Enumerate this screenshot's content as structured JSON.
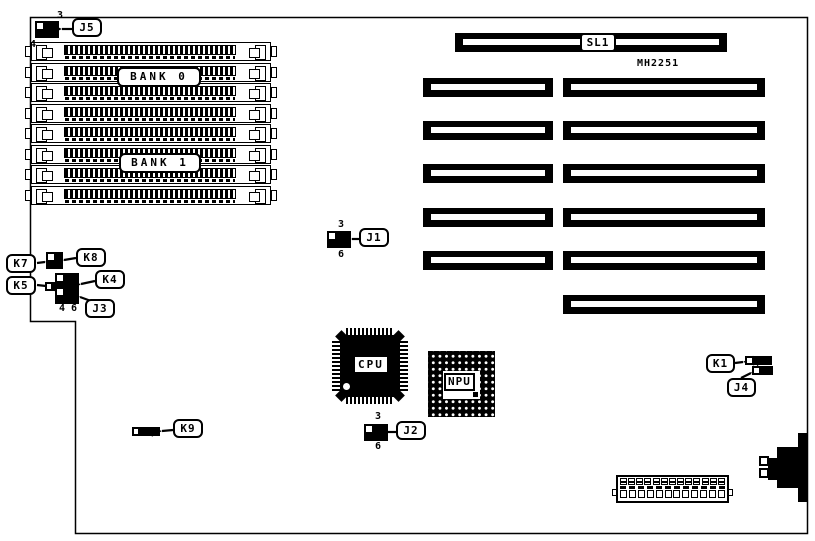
{
  "diagram": {
    "type": "motherboard connector location diagram",
    "part_number": "MH2251",
    "colors": {
      "ink": "#000000",
      "paper": "#ffffff"
    }
  },
  "labels": {
    "j1": "J1",
    "j2": "J2",
    "j3": "J3",
    "j4": "J4",
    "j5": "J5",
    "k1": "K1",
    "k4": "K4",
    "k5": "K5",
    "k7": "K7",
    "k8": "K8",
    "k9": "K9",
    "sl1": "SL1",
    "bank0": "BANK 0",
    "bank1": "BANK 1",
    "cpu": "CPU",
    "npu": "NPU"
  },
  "pins": {
    "j5_top": "3",
    "j5_bottom": "4",
    "j1_top": "3",
    "j1_bottom": "6",
    "j2_top": "3",
    "j2_bottom": "6",
    "j3_left": "4",
    "j3_right": "6"
  },
  "components": {
    "simm_socket_count": 8,
    "expansion_slots_left_column": 5,
    "expansion_slots_right_column": 6,
    "terminal_block_pins_top": 13,
    "terminal_block_pins_bottom": 12
  }
}
